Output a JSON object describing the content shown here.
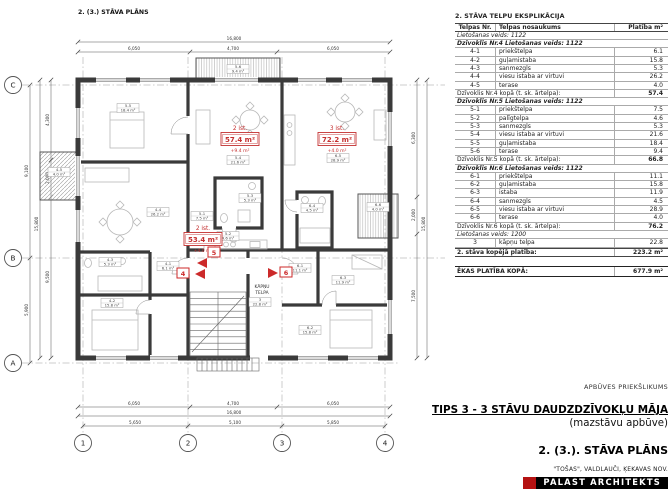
{
  "colors": {
    "accent_red": "#cc2a2a",
    "wall": "#3a3a3a"
  },
  "plan": {
    "title": "2. (3.) STĀVA PLĀNS",
    "grid": {
      "cols": [
        "1",
        "2",
        "3",
        "4"
      ],
      "rows": [
        "C",
        "B",
        "A"
      ]
    },
    "dims": {
      "top_total": "16,800",
      "top_segments": [
        "6,050",
        "4,700",
        "6,050"
      ],
      "bottom_segments": [
        "6,050",
        "4,700",
        "6,050"
      ],
      "bottom_total": "16,800",
      "bottom_grid": [
        "5,650",
        "5,100",
        "5,850"
      ],
      "left_outer": [
        "9,100",
        "5,900"
      ],
      "left_total": "15,800",
      "left_inner": [
        "4,300",
        "2,000",
        "9,500"
      ],
      "right_segments": [
        "6,300",
        "2,000",
        "7,500"
      ],
      "right_total": "15,800"
    },
    "stair": {
      "line1": "KĀPŅU",
      "line2": "TELPA"
    },
    "apartments": [
      {
        "rooms_label": "2 ist.",
        "area": "53.4 m²",
        "extra": "+4.0 m²",
        "entry": "4"
      },
      {
        "rooms_label": "2 ist.",
        "area": "57.4 m²",
        "extra": "+9.4 m²",
        "entry": "5"
      },
      {
        "rooms_label": "3 ist.",
        "area": "72.2 m²",
        "extra": "+4.0 m²",
        "entry": "6"
      }
    ],
    "room_tags": [
      {
        "id": "4-1",
        "area": "6.1 m²"
      },
      {
        "id": "4-2",
        "area": "15.8 m²"
      },
      {
        "id": "4-3",
        "area": "5.3 m²"
      },
      {
        "id": "4-4",
        "area": "26.2 m²"
      },
      {
        "id": "4-5",
        "area": "4.0 m²"
      },
      {
        "id": "5-1",
        "area": "7.5 m²"
      },
      {
        "id": "5-2",
        "area": "4.6 m²"
      },
      {
        "id": "5-3",
        "area": "5.3 m²"
      },
      {
        "id": "5-4",
        "area": "21.6 m²"
      },
      {
        "id": "5-5",
        "area": "18.4 m²"
      },
      {
        "id": "5-6",
        "area": "9.4 m²"
      },
      {
        "id": "6-1",
        "area": "11.1 m²"
      },
      {
        "id": "6-2",
        "area": "15.8 m²"
      },
      {
        "id": "6-3",
        "area": "11.9 m²"
      },
      {
        "id": "6-4",
        "area": "4.5 m²"
      },
      {
        "id": "6-5",
        "area": "28.9 m²"
      },
      {
        "id": "6-6",
        "area": "4.0 m²"
      },
      {
        "id": "3",
        "area": "22.8 m²"
      }
    ]
  },
  "table": {
    "title": "2. STĀVA TELPU EKSPLIKĀCIJA",
    "columns": [
      "Telpas Nr.",
      "Telpas nosaukums",
      "Platība m²"
    ],
    "rows": [
      {
        "kind": "usage",
        "text": "Lietošanas veids: 1122"
      },
      {
        "kind": "apt",
        "text": "Dzīvoklis Nr.4 Lietošanas veids: 1122"
      },
      {
        "kind": "room",
        "nr": "4-1",
        "name": "priekštelpa",
        "area": "6.1"
      },
      {
        "kind": "room",
        "nr": "4-2",
        "name": "guļamistaba",
        "area": "15.8"
      },
      {
        "kind": "room",
        "nr": "4-3",
        "name": "sanmezgls",
        "area": "5.3"
      },
      {
        "kind": "room",
        "nr": "4-4",
        "name": "viesu istaba ar virtuvi",
        "area": "26.2"
      },
      {
        "kind": "room",
        "nr": "4-5",
        "name": "terase",
        "area": "4.0"
      },
      {
        "kind": "total",
        "text": "Dzīvoklis Nr.4 kopā (t. sk. ārtelpa):",
        "area": "57.4"
      },
      {
        "kind": "apt",
        "text": "Dzīvoklis Nr.5 Lietošanas veids: 1122"
      },
      {
        "kind": "room",
        "nr": "5-1",
        "name": "priekštelpa",
        "area": "7.5"
      },
      {
        "kind": "room",
        "nr": "5-2",
        "name": "palīgtelpa",
        "area": "4.6"
      },
      {
        "kind": "room",
        "nr": "5-3",
        "name": "sanmezgls",
        "area": "5.3"
      },
      {
        "kind": "room",
        "nr": "5-4",
        "name": "viesu istaba ar virtuvi",
        "area": "21.6"
      },
      {
        "kind": "room",
        "nr": "5-5",
        "name": "guļamistaba",
        "area": "18.4"
      },
      {
        "kind": "room",
        "nr": "5-6",
        "name": "terase",
        "area": "9.4"
      },
      {
        "kind": "total",
        "text": "Dzīvoklis Nr.5 kopā (t. sk. ārtelpa):",
        "area": "66.8"
      },
      {
        "kind": "apt",
        "text": "Dzīvoklis Nr.6 Lietošanas veids: 1122"
      },
      {
        "kind": "room",
        "nr": "6-1",
        "name": "priekštelpa",
        "area": "11.1"
      },
      {
        "kind": "room",
        "nr": "6-2",
        "name": "guļamistaba",
        "area": "15.8"
      },
      {
        "kind": "room",
        "nr": "6-3",
        "name": "istaba",
        "area": "11.9"
      },
      {
        "kind": "room",
        "nr": "6-4",
        "name": "sanmezgls",
        "area": "4.5"
      },
      {
        "kind": "room",
        "nr": "6-5",
        "name": "viesu istaba ar virtuvi",
        "area": "28.9"
      },
      {
        "kind": "room",
        "nr": "6-6",
        "name": "terase",
        "area": "4.0"
      },
      {
        "kind": "total",
        "text": "Dzīvoklis Nr.6 kopā (t. sk. ārtelpa):",
        "area": "76.2"
      },
      {
        "kind": "usage",
        "text": "Lietošanas veids: 1200"
      },
      {
        "kind": "room",
        "nr": "3",
        "name": "kāpņu telpa",
        "area": "22.8"
      },
      {
        "kind": "floor_total",
        "text": "2. stāva kopējā platība:",
        "area": "223.2 m²"
      }
    ],
    "building_total": {
      "label": "ĒKAS PLATĪBA KOPĀ:",
      "value": "677.9 m²"
    }
  },
  "titleblock": {
    "note": "APBŪVES PRIEKŠLIKUMS",
    "project_title": "TIPS 3 - 3 STĀVU DAUDZDZĪVOKĻU MĀJA",
    "project_subtitle": "(mazstāvu apbūve)",
    "sheet_title": "2. (3.). STĀVA PLĀNS",
    "address": "\"TOŠAS\", VALDLAUČI, ĶEKAVAS NOV.",
    "firm": "PALAST ARCHITEKTS"
  }
}
